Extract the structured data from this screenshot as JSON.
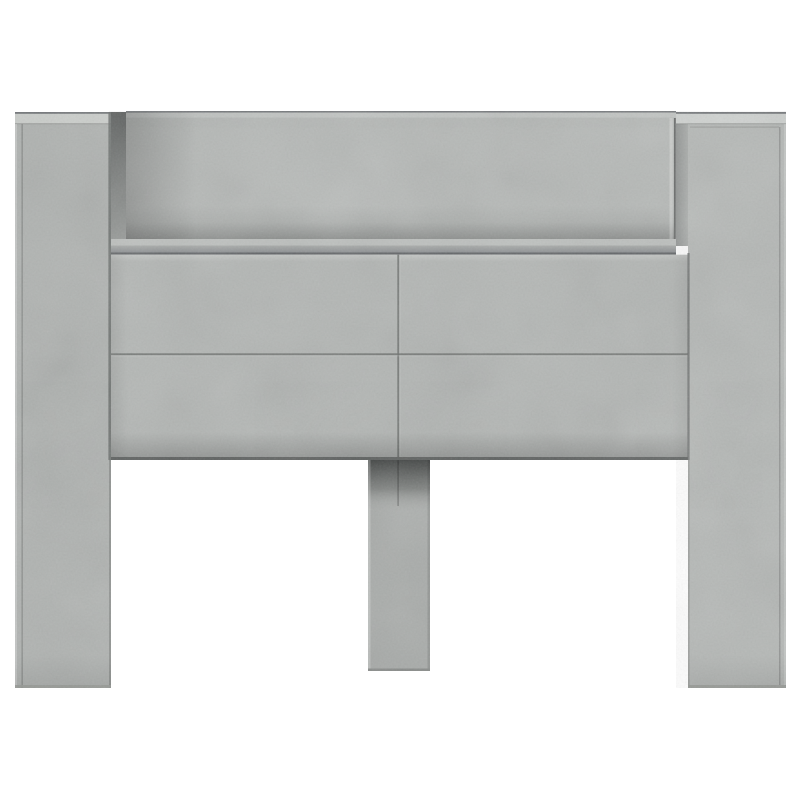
{
  "scene": {
    "type": "product-photo",
    "subject": "headboard-cabinet-concrete-grey",
    "background": "#ffffff"
  },
  "palette": {
    "background": "#ffffff",
    "back_wall_top": "#b6b9b7",
    "back_wall_bottom": "#a1a4a2",
    "top_edge_line": "#75787b",
    "panel_top_edge_light": "#c4c7c5",
    "bevel_left": "#cbcecb",
    "bevel_right": "#d0d3d1",
    "recess_left_face_top": "#5c5f5e",
    "recess_left_face_bottom": "#999c9a",
    "recess_right_face_inner": "#8c8f8e",
    "recess_right_face_outer": "#abaeac",
    "shelf_floor": "#bdc0be",
    "shelf_edge_top": "#a8aba9",
    "shelf_edge_bottom": "#8c8f92",
    "shelf_lip_line": "#616467",
    "front_face": "#b3b6b4",
    "front_face_top_light": "#bec1bf",
    "seam_line": "#6f7270",
    "bottom_edge_line": "#5d605f",
    "left_pillar_face": "#afb2b0",
    "right_pillar_face": "#b5b8b6",
    "pillar_seam": "#696c6b",
    "pillar_bottom_line": "#90938f",
    "leg_face": "#a9acaa",
    "leg_shadow_dark": "#414443",
    "leg_shadow_mid": "#7b7e7c",
    "leg_bottom_line": "#8a8d8b"
  }
}
